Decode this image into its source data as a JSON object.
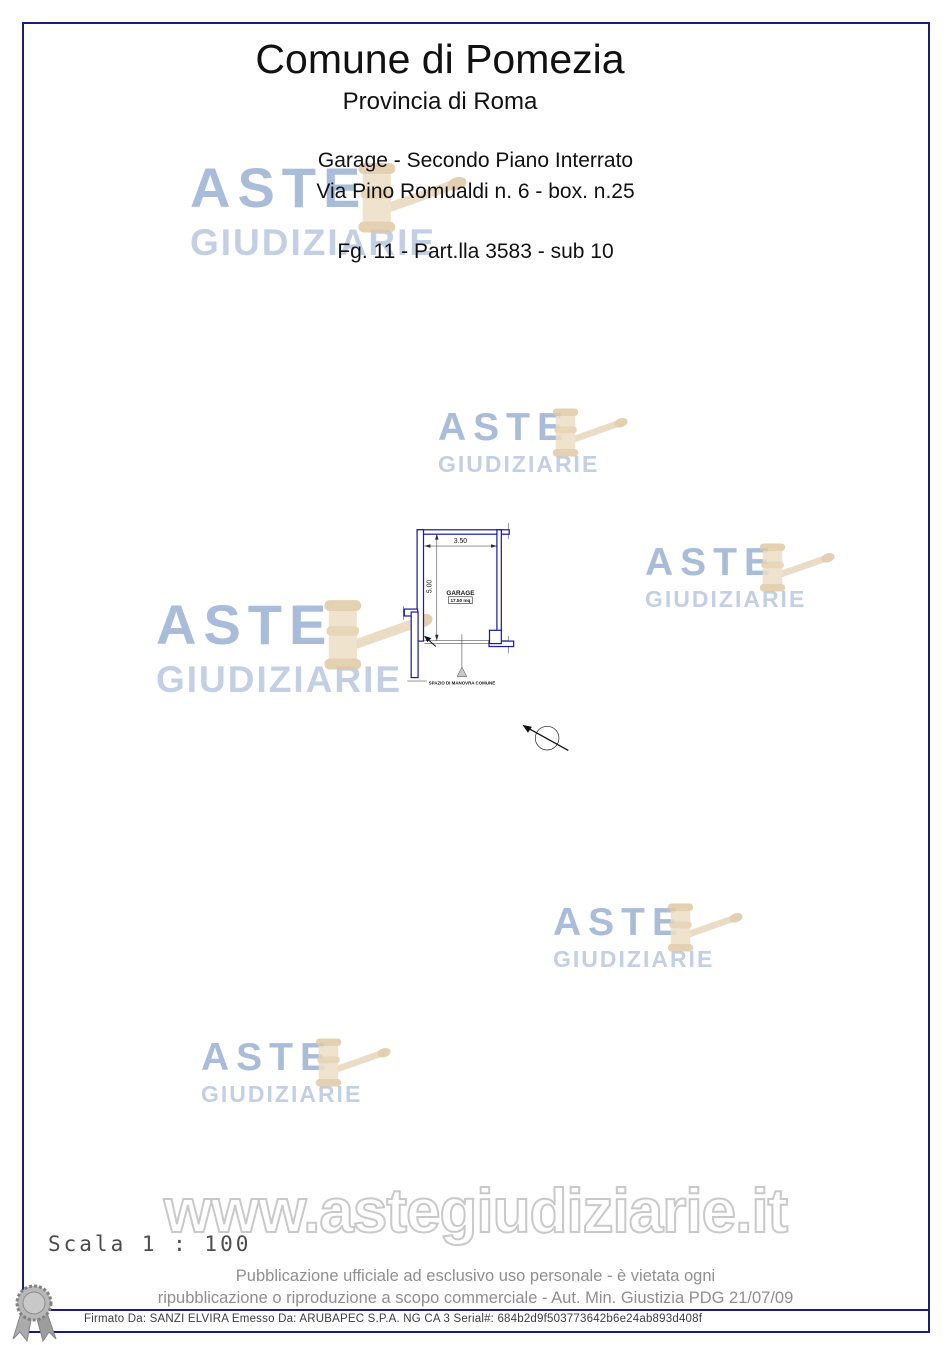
{
  "header": {
    "title": "Comune di Pomezia",
    "subtitle": "Provincia di Roma",
    "property_line1": "Garage - Secondo Piano Interrato",
    "property_line2": "Via Pino Romualdi n. 6 - box. n.25",
    "cadastral_ref": "Fg. 11 - Part.lla 3583 - sub 10"
  },
  "watermark": {
    "line1": "ASTE",
    "line2": "GIUDIZIARIE",
    "url": "www.astegiudiziarie.it",
    "text_color": "#a9bcd9",
    "gavel_color": "#e8d8bc"
  },
  "plan": {
    "room_label": "GARAGE",
    "room_area": "17.50 mq",
    "dim_width": "3.50",
    "dim_height": "5.00",
    "outside_label": "SPAZIO DI MANOVRA COMUNE",
    "wall_color": "#1c1ca8",
    "scale_label": "Scala 1 : 100"
  },
  "footer": {
    "line1": "Pubblicazione ufficiale ad esclusivo uso personale - è vietata ogni",
    "line2": "ripubblicazione o riproduzione a scopo commerciale - Aut. Min. Giustizia PDG 21/07/09",
    "signature": "Firmato Da: SANZI ELVIRA Emesso Da: ARUBAPEC S.P.A. NG CA 3 Serial#: 684b2d9f503773642b6e24ab893d408f"
  }
}
